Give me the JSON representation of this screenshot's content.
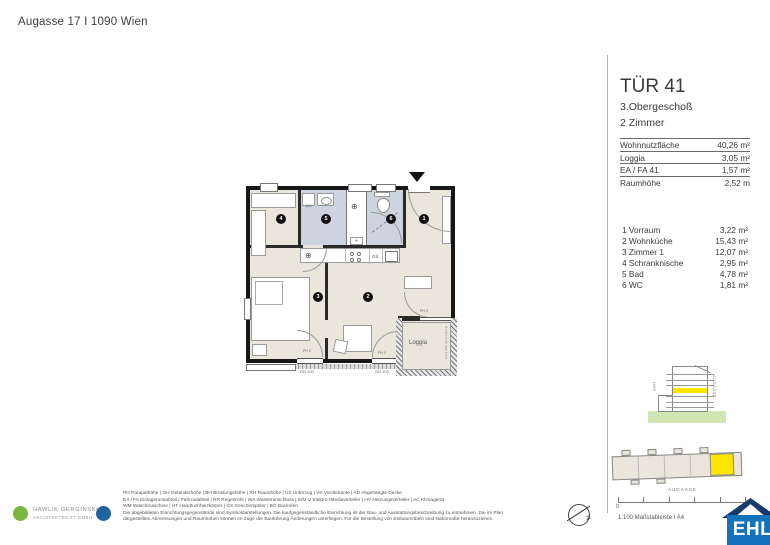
{
  "header": {
    "address": "Augasse 17 I 1090 Wien"
  },
  "unit": {
    "title": "TÜR 41",
    "floor": "3.Obergeschoß",
    "room_count": "2 Zimmer",
    "metrics": [
      {
        "label": "Wohnnutzfläche",
        "value": "40,26 m²"
      },
      {
        "label": "Loggia",
        "value": "3,05 m²"
      },
      {
        "label": "EA / FA 41",
        "value": "1,57 m²"
      },
      {
        "label": "Raumhöhe",
        "value": "2,52 m"
      }
    ],
    "rooms": [
      {
        "label": "1 Vorraum",
        "value": "3,22 m²"
      },
      {
        "label": "2 Wohnküche",
        "value": "15,43 m²"
      },
      {
        "label": "3 Zimmer 1",
        "value": "12,07 m²"
      },
      {
        "label": "4 Schranknische",
        "value": "2,95 m²"
      },
      {
        "label": "5 Bad",
        "value": "4,78 m²"
      },
      {
        "label": "6 WC",
        "value": "1,81 m²"
      }
    ]
  },
  "plan": {
    "numbers": [
      "1",
      "2",
      "3",
      "4",
      "5",
      "6"
    ],
    "labels": {
      "loggia": "Loggia",
      "wm": "WM",
      "gs": "GS",
      "sink": "⊕",
      "wa": "⊕",
      "gh_left": "GH 100",
      "gh_right": "GH 102",
      "ph_left": "PH 0",
      "ph_right": "PH 0",
      "ph_loggia": "PH 0",
      "loggia_side": "Senkrechtmarkise"
    }
  },
  "keyplan": {
    "hof": "HOF",
    "street_side": "AUGASSE",
    "street_site": "AUGASSE"
  },
  "scalebar": {
    "zero": "0",
    "caption": "1:100 Maßstableiste I A4"
  },
  "compass": {
    "label": "N"
  },
  "legend": {
    "lines": [
      "PH Parapethöhe | GH Geländerhöhe | BH Brüstungshöhe  |  RH Raumhöhe | UZ Unterzug | VK Vorderkante | AD Abgehängte Decke",
      "EA / FA Einlagerunsabteil / Fahrradabteil | RR Regenrohr | WA Wasseranschluss | E/M-V Elektro-/Mediaverteiler | HV Heizungsverteiler | AC Klimagerät",
      "WM Waschmaschine | HT Handtuchheizkörper | GS Geschirrspüler | BO Backofen",
      "Die abgebildeten Einrichtungsgegenstände sind Symboldarstellungen. Die kaufgegenständliche Einrichtung ist der Bau- und Ausstattungsbeschreibung zu entnehmen. Die im Plan",
      "dargestellten Abmessungen und Raumhöhen können im Zuge der Bauführung Änderungen unterliegen. Für die Bestellung von Einbaumöbeln sind Naturmaße heranzuziehen."
    ]
  },
  "architect": {
    "name": "HAWLIK GERGINSKI",
    "sub": "ARCHITEKTEN ZT GMBH"
  },
  "brand": {
    "name": "EHL"
  },
  "colors": {
    "highlight_yellow": "#FFE500",
    "floor_beige": "#EAE6DC",
    "floor_wet": "#CDD4E0",
    "ground_green": "#D2E5B4",
    "ehl_blue": "#1472BA",
    "ehl_roof": "#15396B",
    "logo_green": "#7DB63F",
    "logo_blue": "#2262A0"
  }
}
